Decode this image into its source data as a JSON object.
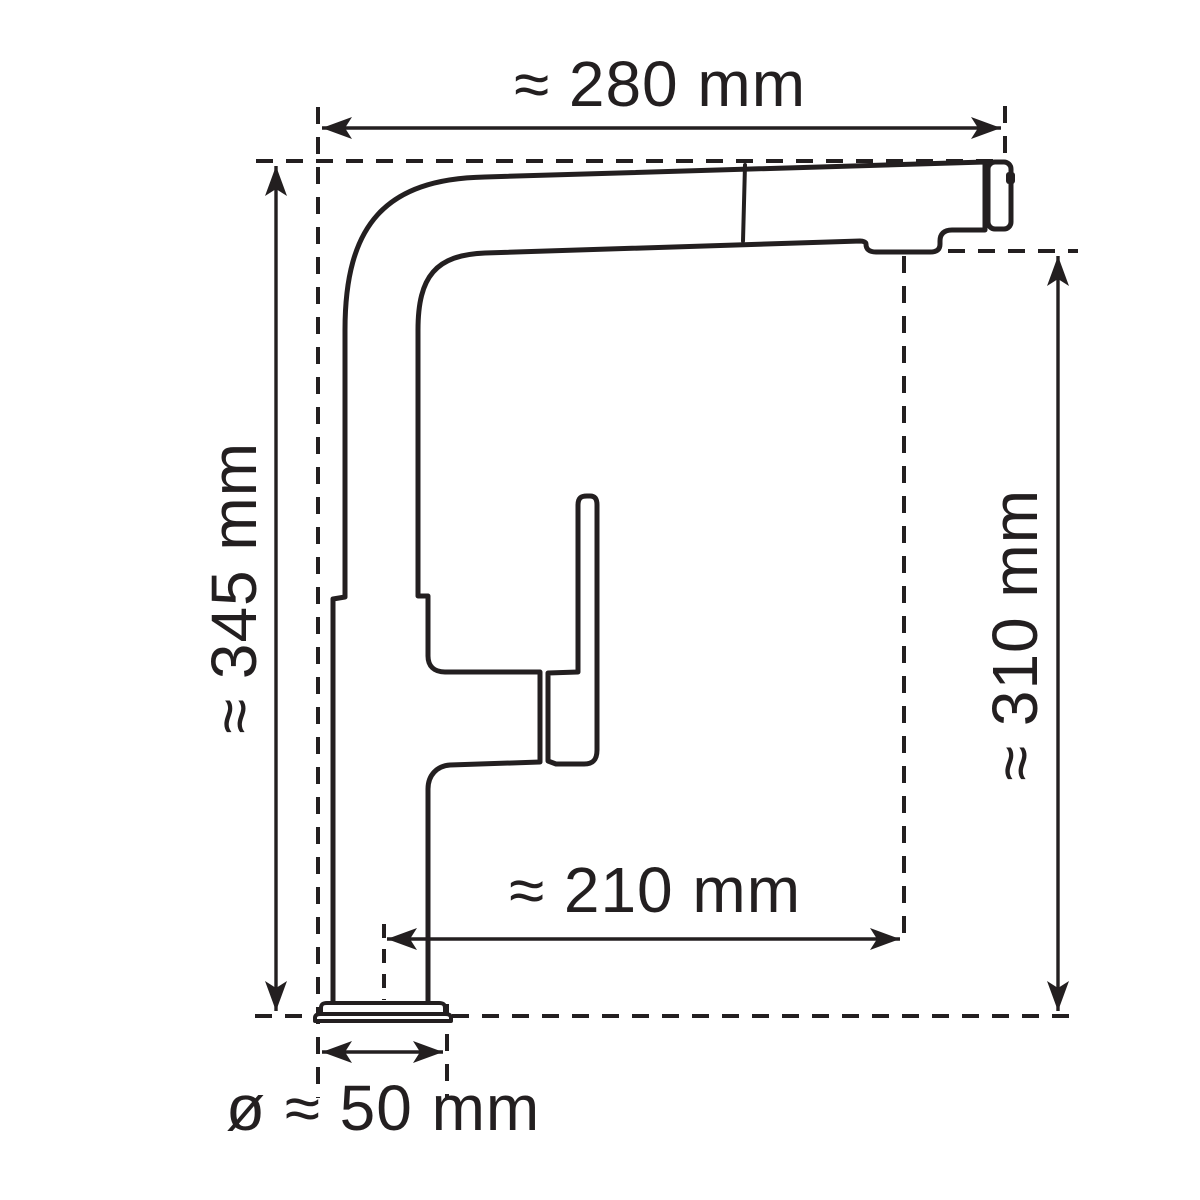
{
  "diagram": {
    "type": "technical-dimension-drawing",
    "subject": "kitchen mixer tap with pull-out spray head, side elevation",
    "units": "mm",
    "ink_color": "#231f20",
    "background_color": "#ffffff",
    "dimensions": [
      {
        "id": "overall-width",
        "label": "≈ 280 mm",
        "value_mm": 280,
        "orientation": "horizontal",
        "position": "top"
      },
      {
        "id": "overall-height",
        "label": "≈ 345 mm",
        "value_mm": 345,
        "orientation": "vertical",
        "position": "left"
      },
      {
        "id": "outlet-height",
        "label": "≈ 310 mm",
        "value_mm": 310,
        "orientation": "vertical",
        "position": "right"
      },
      {
        "id": "spout-reach",
        "label": "≈ 210 mm",
        "value_mm": 210,
        "orientation": "horizontal",
        "position": "lower-middle"
      },
      {
        "id": "base-diameter",
        "label": "ø ≈ 50 mm",
        "value_mm": 50,
        "orientation": "horizontal",
        "position": "bottom"
      }
    ]
  }
}
